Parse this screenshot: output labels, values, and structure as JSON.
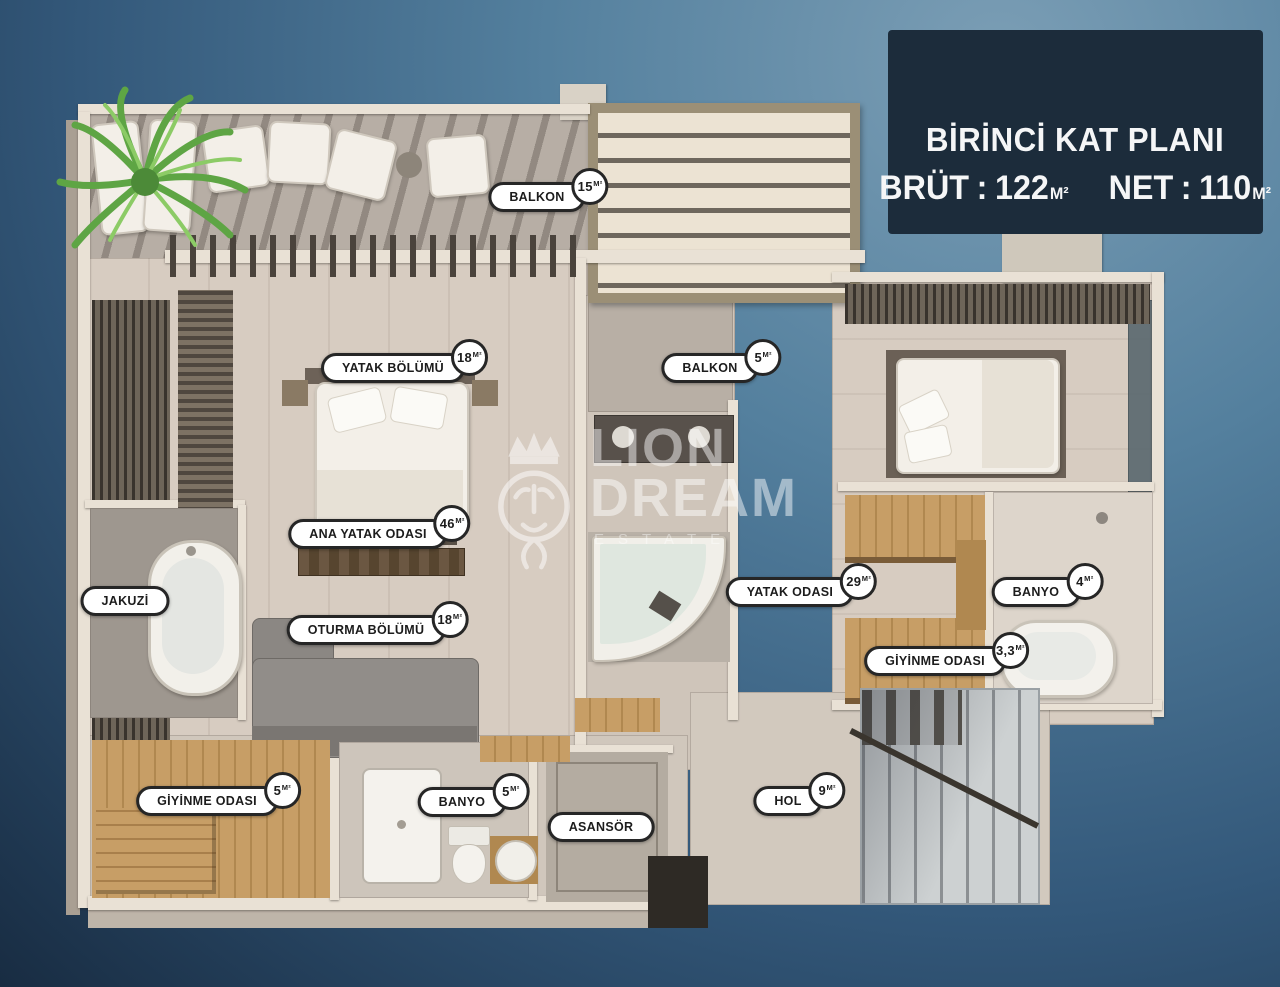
{
  "title_box": {
    "title": "BİRİNCİ KAT PLANI",
    "brut_label": "BRÜT",
    "net_label": "NET",
    "separator": ":",
    "brut_value": "122",
    "net_value": "110",
    "unit": "M²"
  },
  "units": {
    "m2": "M²"
  },
  "labels": [
    {
      "text": "BALKON",
      "area": "15"
    },
    {
      "text": "YATAK BÖLÜMÜ",
      "area": "18"
    },
    {
      "text": "BALKON",
      "area": "5"
    },
    {
      "text": "ANA YATAK ODASI",
      "area": "46"
    },
    {
      "text": "JAKUZİ",
      "area": ""
    },
    {
      "text": "OTURMA BÖLÜMÜ",
      "area": "18"
    },
    {
      "text": "YATAK ODASI",
      "area": "29"
    },
    {
      "text": "BANYO",
      "area": "4"
    },
    {
      "text": "GİYİNME ODASI",
      "area": "3,3"
    },
    {
      "text": "GİYİNME ODASI",
      "area": "5"
    },
    {
      "text": "BANYO",
      "area": "5"
    },
    {
      "text": "ASANSÖR",
      "area": ""
    },
    {
      "text": "HOL",
      "area": "9"
    }
  ],
  "watermark": {
    "logo": "lion-crown-logo",
    "brand_line1": "LION",
    "brand_line2": "DREAM",
    "brand_line3": "ESTATE"
  },
  "colors": {
    "background_top": "#7b9eb5",
    "background_bottom": "#182c42",
    "title_box_bg": "#1c2c3b",
    "label_bg": "#ffffff",
    "label_border": "#262626",
    "floor_beige": "#d7ccc1",
    "floor_gray": "#9e978f",
    "wall_cream": "#e9e1d5",
    "wood": "#c79e66",
    "sofa_gray": "#8b8783",
    "water_mint": "#dfe7df",
    "plant_green": "#6fae4e",
    "stairs_marble": "#cdd1d2"
  }
}
